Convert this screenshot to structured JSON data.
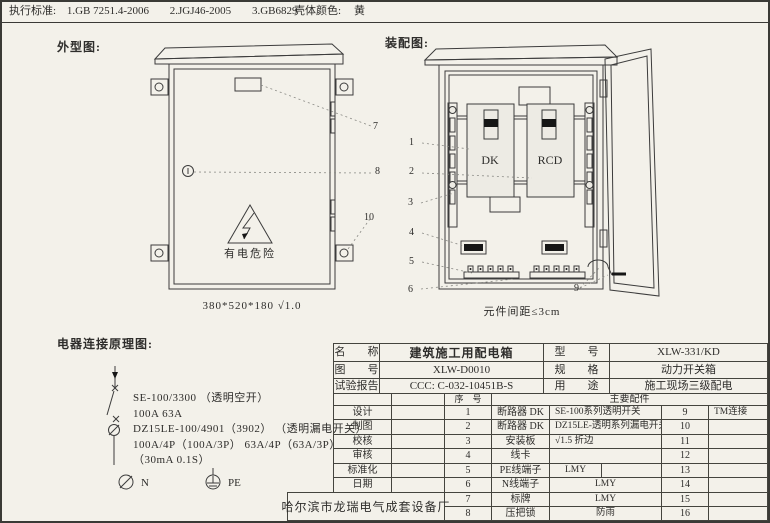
{
  "colors": {
    "paper": "#f3f1ea",
    "line": "#3c3c3c",
    "shell_color": "黄"
  },
  "title_bar": {
    "standards_label": "执行标准:",
    "standards": [
      "1.GB 7251.4-2006",
      "2.JGJ46-2005",
      "3.GB6829"
    ],
    "shell_color_label": "壳体颜色:",
    "shell_color_value": "黄"
  },
  "sections": {
    "outline_title": "外型图:",
    "assembly_title": "装配图:",
    "schematic_title": "电器连接原理图:"
  },
  "outline_drawing": {
    "warning_text": "有电危险",
    "dimension_note": "380*520*180  √1.0",
    "callout_7": "7",
    "callout_8": "8",
    "callout_10": "10"
  },
  "assembly_drawing": {
    "dk_label": "DK",
    "rcd_label": "RCD",
    "spacing_note": "元件间距≤3cm",
    "callout_1": "1",
    "callout_2": "2",
    "callout_3": "3",
    "callout_4": "4",
    "callout_5": "5",
    "callout_6": "6",
    "callout_9": "9"
  },
  "schematic": {
    "line_1": "SE-100/3300 （透明空开）",
    "line_2": "100A  63A",
    "line_3": "DZ15LE-100/4901（3902） （透明漏电开关）",
    "line_4": "100A/4P（100A/3P） 63A/4P（63A/3P）",
    "line_5": "（30mA 0.1S）",
    "n_label": "N",
    "pe_label": "PE"
  },
  "info_table": {
    "name_label": "名　　称",
    "name_value": "建筑施工用配电箱",
    "model_label": "型　　号",
    "model_value": "XLW-331/KD",
    "drawing_no_label": "图　　号",
    "drawing_no_value": "XLW-D0010",
    "spec_label": "规　　格",
    "spec_value": "动力开关箱",
    "report_label": "试验报告",
    "report_value": "CCC: C-032-10451B-S",
    "use_label": "用　　途",
    "use_value": "施工现场三级配电",
    "seq_header": "序　号",
    "parts_header": "主要配件"
  },
  "sign_block": {
    "rows": [
      "设计",
      "制图",
      "校核",
      "审核",
      "标准化",
      "日期"
    ]
  },
  "parts": [
    {
      "seq": "1",
      "name": "断路器 DK",
      "spec": "SE-100系列透明开关",
      "seq2": "9",
      "spec2": "TM连接"
    },
    {
      "seq": "2",
      "name": "断路器 DK",
      "spec": "DZ15LE-透明系列漏电开关",
      "seq2": "10",
      "spec2": ""
    },
    {
      "seq": "3",
      "name": "安装板",
      "spec": "√1.5 折边",
      "seq2": "11",
      "spec2": ""
    },
    {
      "seq": "4",
      "name": "线卡",
      "spec": "",
      "seq2": "12",
      "spec2": ""
    },
    {
      "seq": "5",
      "name": "PE线端子",
      "spec": "LMY",
      "seq2": "13",
      "spec2": ""
    },
    {
      "seq": "6",
      "name": "N线端子",
      "spec": "LMY",
      "seq2": "14",
      "spec2": ""
    },
    {
      "seq": "7",
      "name": "标牌",
      "spec": "LMY",
      "seq2": "15",
      "spec2": ""
    },
    {
      "seq": "8",
      "name": "压把锁",
      "spec": "防雨",
      "seq2": "16",
      "spec2": ""
    }
  ],
  "stamp": {
    "factory_name": "哈尔滨市龙瑞电气成套设备厂"
  }
}
